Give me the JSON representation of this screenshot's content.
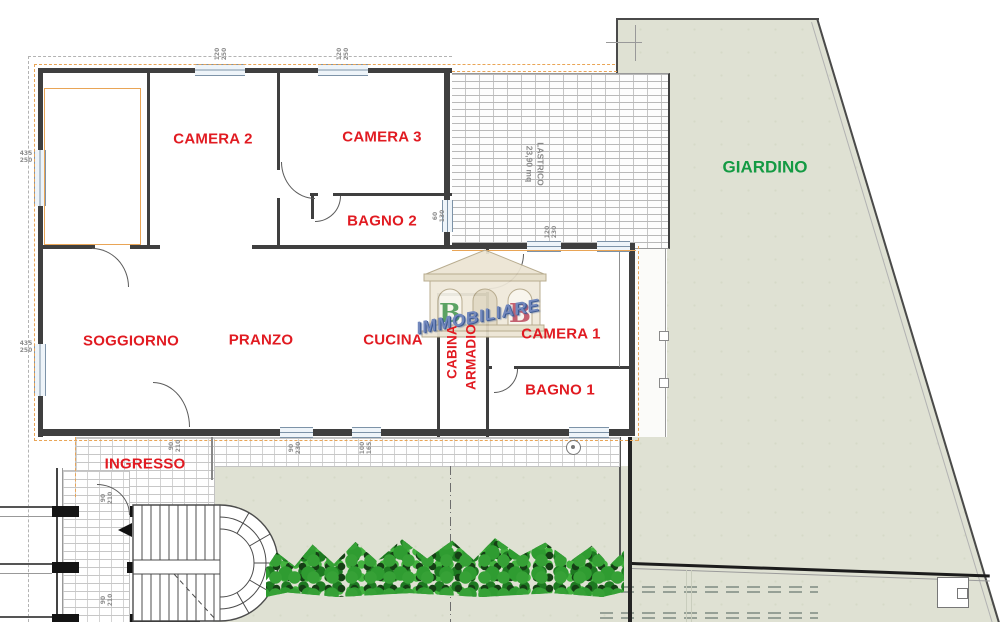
{
  "rooms": {
    "camera2": "CAMERA 2",
    "camera3": "CAMERA 3",
    "bagno2": "BAGNO 2",
    "soggiorno": "SOGGIORNO",
    "pranzo": "PRANZO",
    "cucina": "CUCINA",
    "cabina": "CABINA",
    "armadio": "ARMADIO",
    "camera1": "CAMERA 1",
    "bagno1": "BAGNO 1",
    "ingresso": "INGRESSO"
  },
  "outdoor": {
    "giardino": "GIARDINO",
    "lastrico": "LASTRICO\n23,90 mq"
  },
  "watermark": {
    "letter_left": "B",
    "letter_right": "B",
    "brand": "IMMOBILIARE"
  },
  "dimensions": {
    "top_window_left": "120\n250",
    "top_window_right": "120\n250",
    "left_wall_upper": "435\n250",
    "left_wall_lower": "435\n250",
    "terrace_wall_window": "120\n230",
    "bagno2_window": "60\n130",
    "bottom_window_left": "90\n230",
    "bottom_window_right": "100\n165",
    "entrance_door": "90\n210",
    "stair_door_upper": "90\n210",
    "stair_door_lower": "90\n210"
  },
  "colors": {
    "room_label_red": "#e11b22",
    "garden_label_green": "#149a43",
    "garden_fill": "#dfe1d3",
    "property_line_orange": "#e9a556",
    "wall_gray": "#3f3f3f",
    "watermark_blue": "#7288bd",
    "hedge_green": "#2f9c31"
  }
}
